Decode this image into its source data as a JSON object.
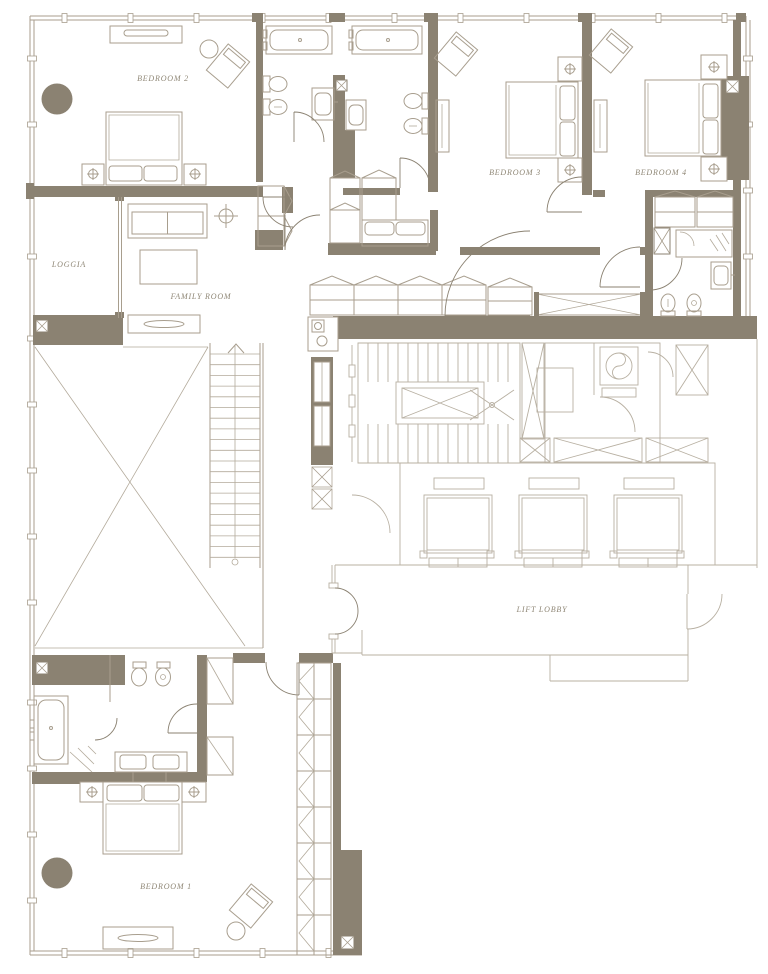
{
  "plan": {
    "title": "Apartment floor plan",
    "rooms": [
      {
        "id": "bedroom-2",
        "label": "BEDROOM 2"
      },
      {
        "id": "bedroom-3",
        "label": "BEDROOM 3"
      },
      {
        "id": "bedroom-4",
        "label": "BEDROOM 4"
      },
      {
        "id": "loggia",
        "label": "LOGGIA"
      },
      {
        "id": "family-room",
        "label": "FAMILY ROOM"
      },
      {
        "id": "lift-lobby",
        "label": "LIFT LOBBY"
      },
      {
        "id": "bedroom-1",
        "label": "BEDROOM 1"
      }
    ],
    "colors": {
      "wall": "#8b8272",
      "furniture_line": "#a89e8e",
      "common_line": "#b8b0a2",
      "label_text": "#8f8776",
      "background": "#ffffff"
    },
    "icons": [
      "bathtub-icon",
      "toilet-icon",
      "bidet-icon",
      "basin-icon",
      "shower-icon",
      "bed-icon",
      "wardrobe-icon",
      "sofa-icon",
      "armchair-icon",
      "washer-icon",
      "stair-icon",
      "lift-icon",
      "column-icon",
      "ceiling-light-icon",
      "door-swing-icon",
      "void-cross-icon",
      "window-mullion-icon"
    ]
  }
}
